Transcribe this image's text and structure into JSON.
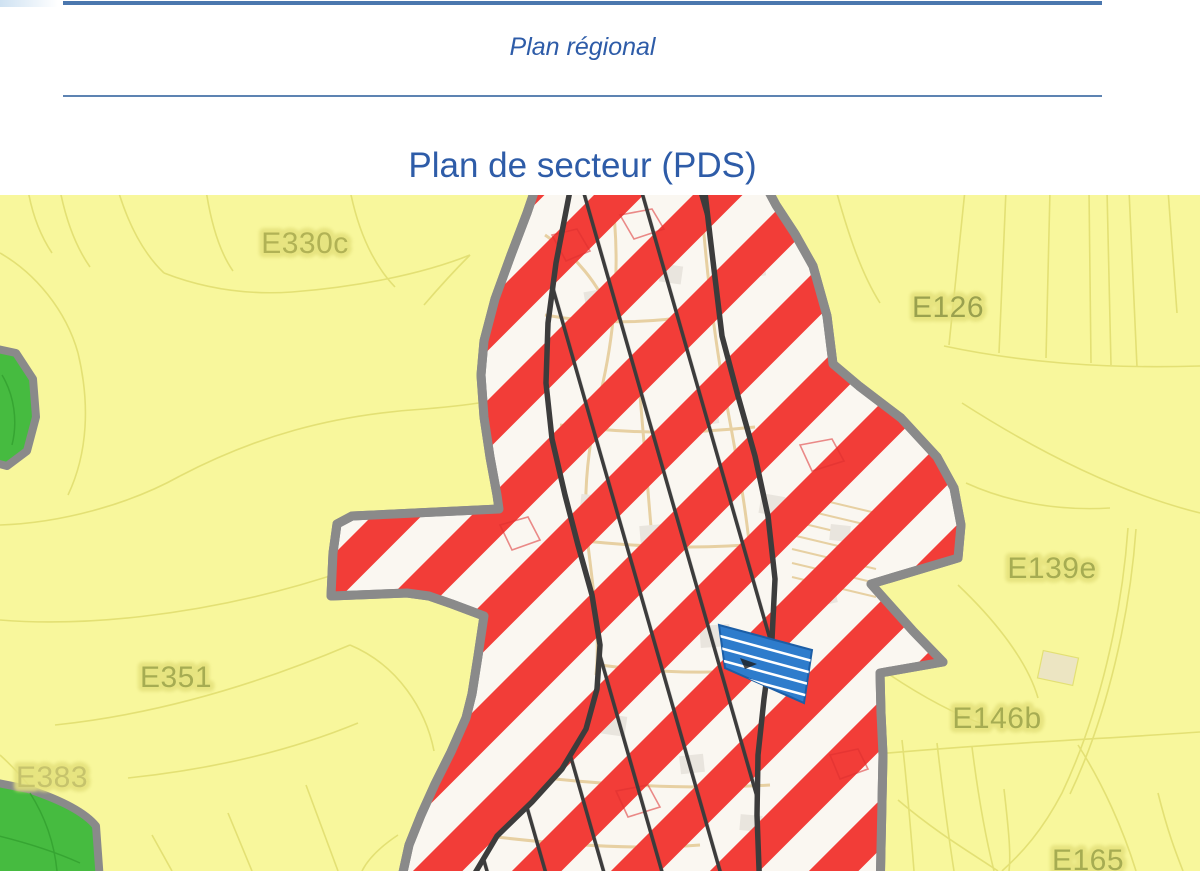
{
  "header": {
    "subtitle": "Plan régional",
    "title": "Plan de secteur (PDS)"
  },
  "colors": {
    "titleBlue": "#2e5ca8",
    "ruleBlue": "#4b77ae",
    "ruleBlue2": "#5d83b2",
    "yellow": "#f8f79c",
    "parcel": "#e3e074",
    "green": "#46bb40",
    "greenLine": "#36a532",
    "gray": "#8a8a8a",
    "dark": "#3c3c3c",
    "red": "#f23d38",
    "zoneBase": "#faf7f1",
    "street": "#e7d0a2",
    "building": "#e9e5de",
    "beige": "#ece5c2",
    "blue": "#2e7ccc",
    "blueDark": "#1c5ea6",
    "labelHalo": "#e4e17c",
    "redLine": "#dd2f2f"
  },
  "map": {
    "labels": [
      {
        "text": "E330c",
        "x": 305,
        "y": 58,
        "color": "#b1b255"
      },
      {
        "text": "E126",
        "x": 948,
        "y": 122,
        "color": "#9aa14e"
      },
      {
        "text": "E139e",
        "x": 1052,
        "y": 383,
        "color": "#a6ac52"
      },
      {
        "text": "E351",
        "x": 176,
        "y": 492,
        "color": "#a6ac52"
      },
      {
        "text": "E146b",
        "x": 997,
        "y": 533,
        "color": "#a6ac52"
      },
      {
        "text": "E383",
        "x": 52,
        "y": 592,
        "color": "#c6c36c"
      },
      {
        "text": "E165",
        "x": 1088,
        "y": 675,
        "color": "#a6ac52"
      }
    ]
  }
}
